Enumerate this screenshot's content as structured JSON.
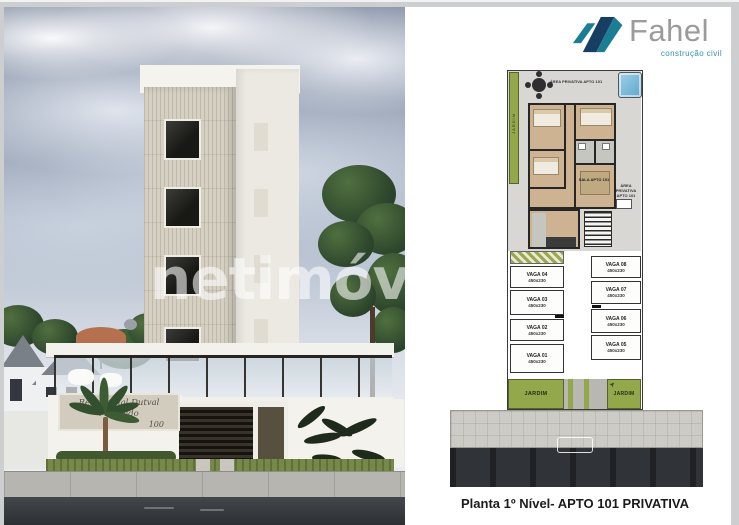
{
  "page": {
    "caption": "Planta 1º Nível- APTO 101 PRIVATIVA"
  },
  "brand": {
    "name": "Fahel",
    "tagline": "construção civil",
    "colors": {
      "teal": "#1c7e94",
      "navy": "#173e63",
      "text_gray": "#9b9b9b"
    }
  },
  "photo": {
    "watermark": "netimóve",
    "sign_line1": "Residencial Dutval Machado",
    "sign_line2": "100"
  },
  "plan": {
    "label_area_top": "ÁREA PRIVATIVA APTO 101",
    "label_area_right": "ÁREA PRIVATIVA APTO 101",
    "label_sala": "SALA APTO 101",
    "garden_strip": "JARDIM",
    "garden_left": "JARDIM",
    "garden_right": "JARDIM",
    "parking_left": [
      {
        "name": "VAGA 04",
        "dim": "450x230"
      },
      {
        "name": "VAGA 03",
        "dim": "450x230"
      },
      {
        "name": "VAGA 02",
        "dim": "450x230"
      },
      {
        "name": "VAGA 01",
        "dim": "450x230"
      }
    ],
    "parking_right": [
      {
        "name": "VAGA 08",
        "dim": "450x230"
      },
      {
        "name": "VAGA 07",
        "dim": "450x230"
      },
      {
        "name": "VAGA 06",
        "dim": "450x230"
      },
      {
        "name": "VAGA 05",
        "dim": "450x230"
      }
    ],
    "colors": {
      "garden_green": "#93a84b",
      "pool_blue": "#7fb6d9",
      "floor_beige": "#cdb391",
      "road_dark": "#303338"
    }
  }
}
